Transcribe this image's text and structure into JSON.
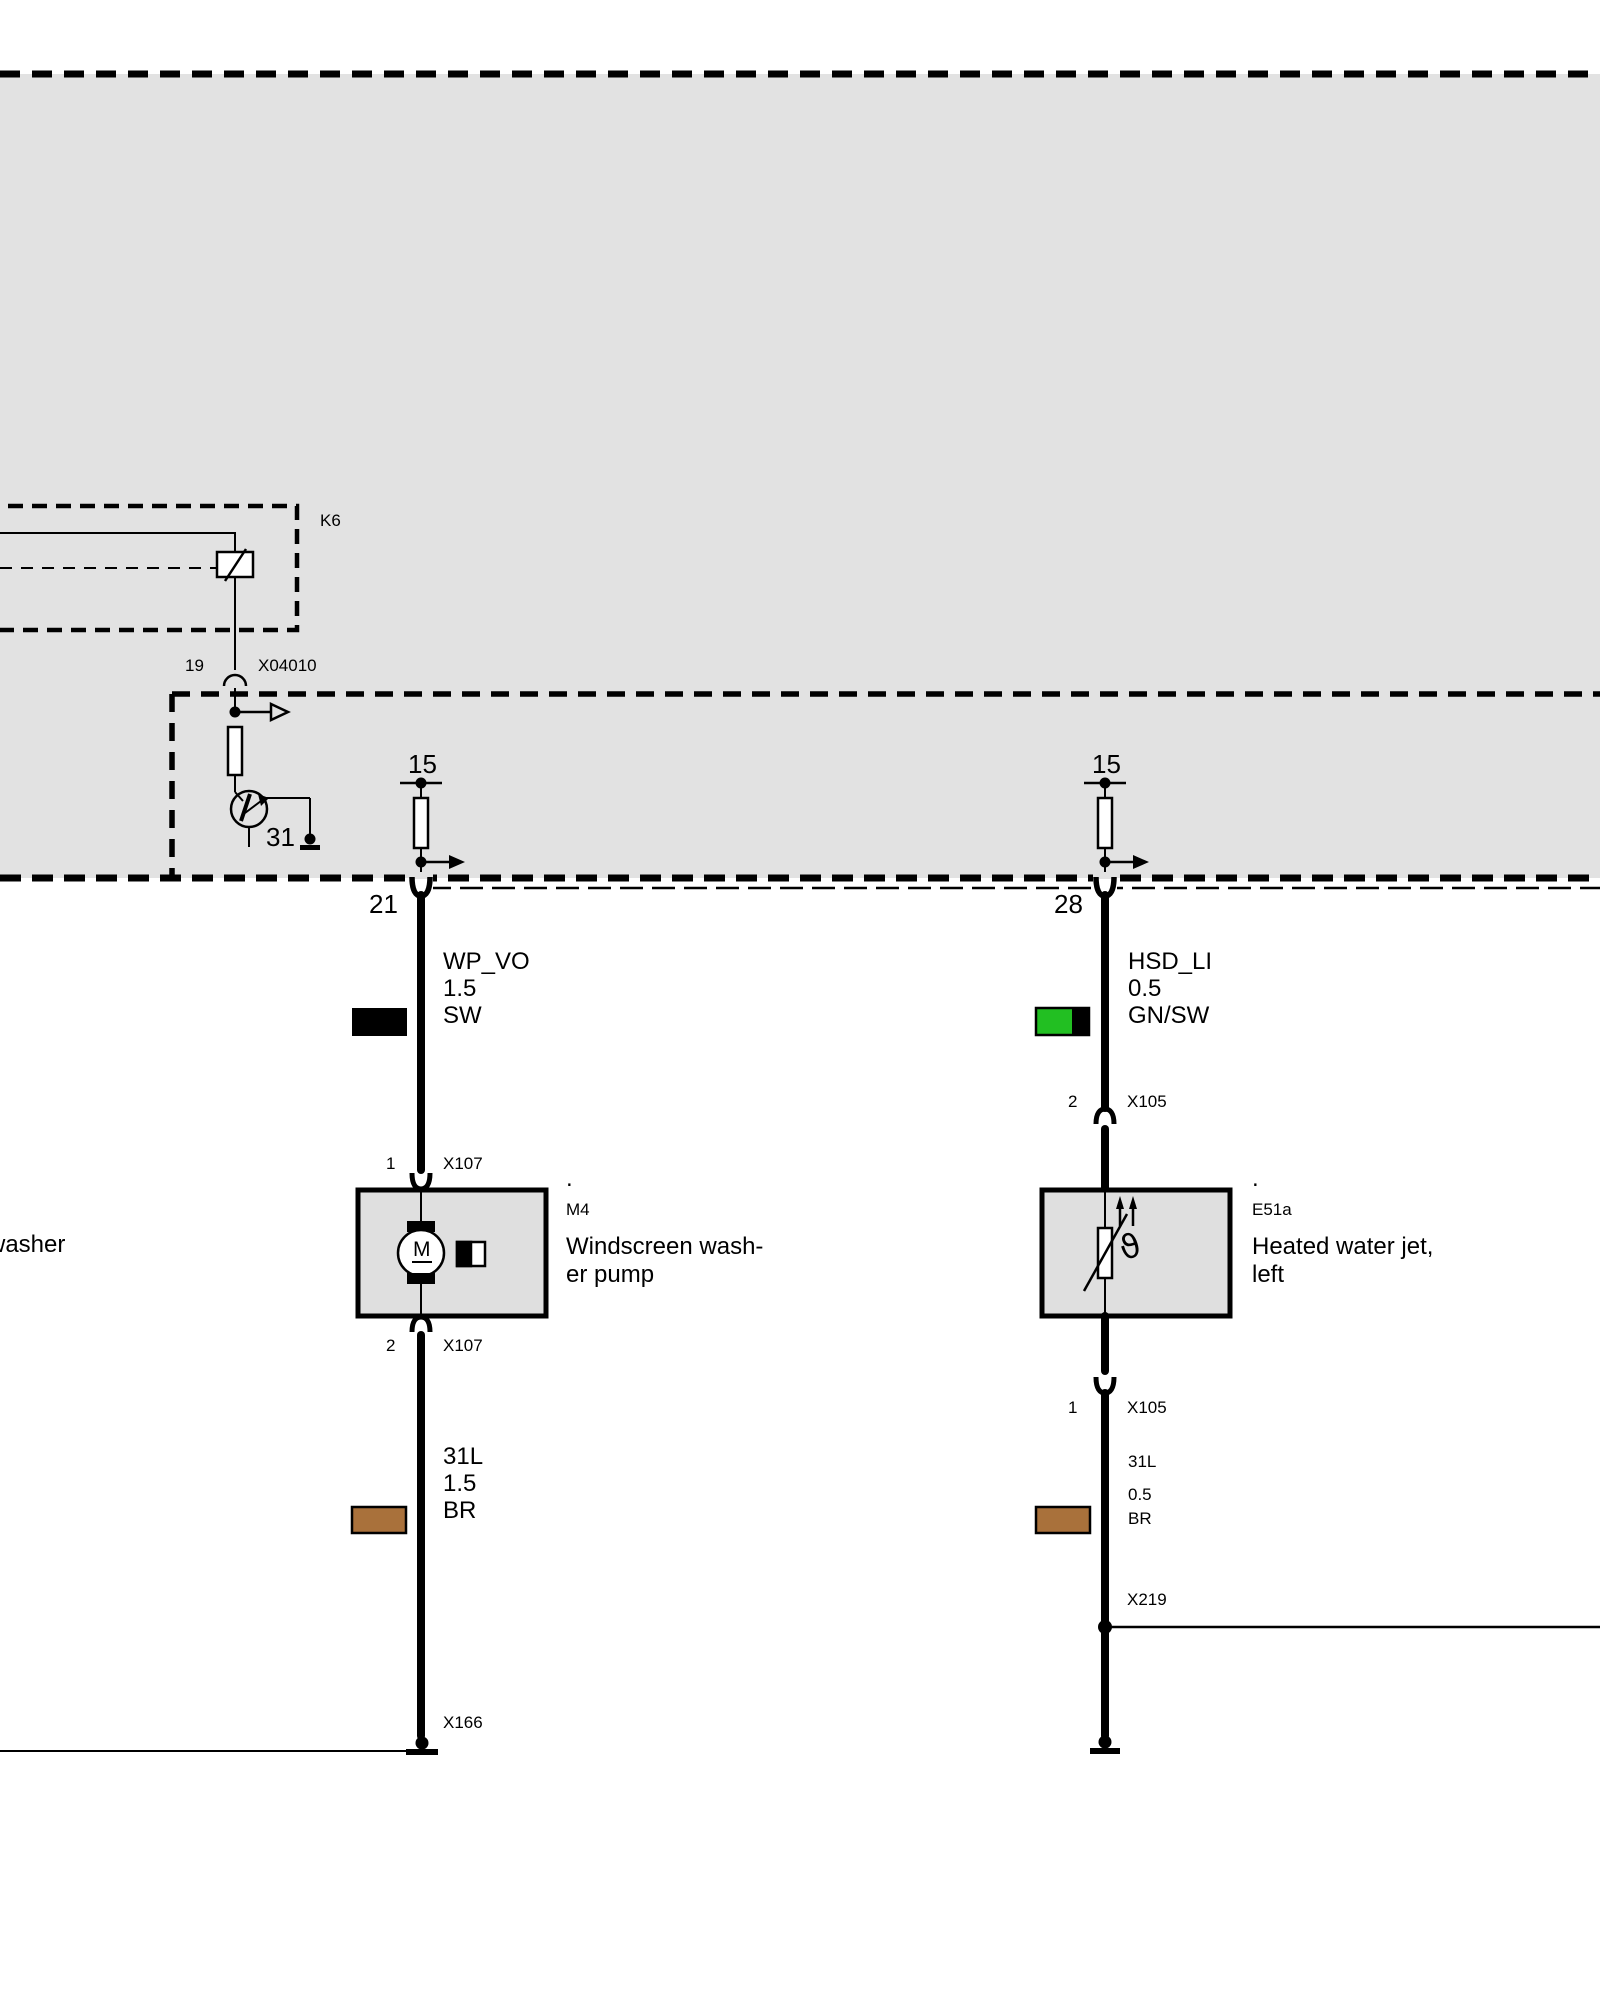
{
  "labels": {
    "k6": "K6",
    "pin19": "19",
    "x04010": "X04010",
    "transistor_ground": "31",
    "fuse_left": "15",
    "fuse_right": "15",
    "pin21": "21",
    "pin28": "28",
    "x166": "X166",
    "x219": "X219",
    "edge_text": "washer"
  },
  "left_wire": {
    "name": "WP_VO",
    "gauge": "1.5",
    "color_code": "SW"
  },
  "right_wire": {
    "name": "HSD_LI",
    "gauge": "0.5",
    "color_code": "GN/SW"
  },
  "left_ground_wire": {
    "name": "31L",
    "gauge": "1.5",
    "color_code": "BR"
  },
  "right_ground_wire": {
    "name": "31L",
    "gauge": "0.5",
    "color_code": "BR"
  },
  "connectors": {
    "m4_top": {
      "pin": "1",
      "name": "X107"
    },
    "m4_bottom": {
      "pin": "2",
      "name": "X107"
    },
    "e51a_top": {
      "pin": "2",
      "name": "X105"
    },
    "e51a_bottom": {
      "pin": "1",
      "name": "X105"
    }
  },
  "components": {
    "m4": {
      "dot": ".",
      "code": "M4",
      "name_line1": "Windscreen wash-",
      "name_line2": "er pump",
      "motor_letter": "M"
    },
    "e51a": {
      "dot": ".",
      "code": "E51a",
      "name_line1": "Heated water jet,",
      "name_line2": "left",
      "theta_symbol": "ϑ"
    }
  },
  "colors": {
    "wire_black": "#000000",
    "wire_green": "#22bf22",
    "wire_brown": "#a9713b",
    "module_bg": "#e2e2e2",
    "component_bg": "#dfdfdf"
  }
}
